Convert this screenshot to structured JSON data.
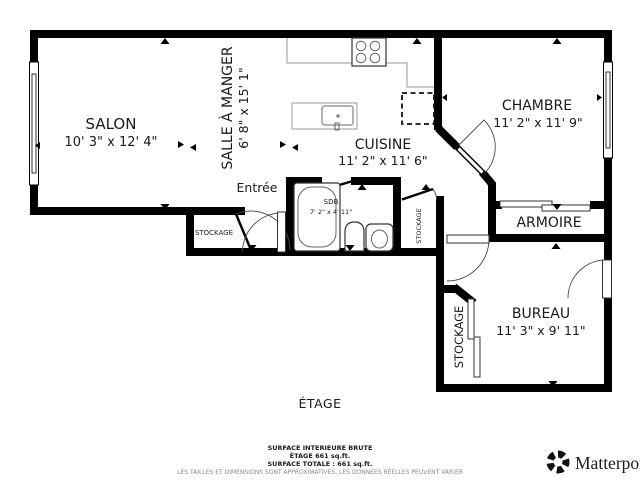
{
  "rooms": {
    "salon": {
      "name": "SALON",
      "dims": "10' 3\" x 12' 4\""
    },
    "salle_a_manger": {
      "name": "SALLE À MANGER",
      "dims": "6' 8\" x 15' 1\""
    },
    "cuisine": {
      "name": "CUISINE",
      "dims": "11' 2\" x 11' 6\""
    },
    "chambre": {
      "name": "CHAMBRE",
      "dims": "11' 2\" x 11' 9\""
    },
    "sdb": {
      "name": "SDB",
      "dims": "7' 2\" x 4' 11\""
    },
    "armoire": {
      "name": "ARMOIRE"
    },
    "bureau": {
      "name": "BUREAU",
      "dims": "11' 3\" x 9' 11\""
    },
    "entree": {
      "name": "Entrée"
    },
    "stockage_salon": {
      "name": "STOCKAGE"
    },
    "stockage_couloir": {
      "name": "STOCKAGE"
    },
    "stockage_bureau": {
      "name": "STOCKAGE"
    }
  },
  "floor": {
    "label": "ÉTAGE"
  },
  "footer": {
    "line1": "SURFACE INTERIEURE BRUTE",
    "line2": "ÉTAGE 661 sq.ft.",
    "line3": "SURFACE TOTALE :  661 sq.ft.",
    "disclaimer": "LES TAILLES ET DIMENSIONS SONT APPROXIMATIVES, LES DONNÉES RÉELLES PEUVENT VARIER"
  },
  "brand": {
    "wordmark": "Matterport"
  },
  "icons": {
    "matterport-logo-icon": "segmented circular shutter",
    "measure-tick-icon": "small solid triangle on wall",
    "dimension-arrow-icon": "small solid arrowhead",
    "door-icon": "quarter-circle swing arc",
    "window-icon": "double-line inset in wall",
    "stove-icon": "square with 4 burner circles",
    "fridge-icon": "dashed square",
    "bathtub-icon": "rounded rectangle tub",
    "toilet-icon": "oval bowl with tank",
    "sink-icon": "pedestal basin"
  },
  "colors": {
    "wall": "#000000",
    "background": "#ffffff",
    "text": "#1a1a1a",
    "disclaimer_text": "#8a8a8a",
    "counter_line": "#999999",
    "fixture_line": "#555555"
  }
}
